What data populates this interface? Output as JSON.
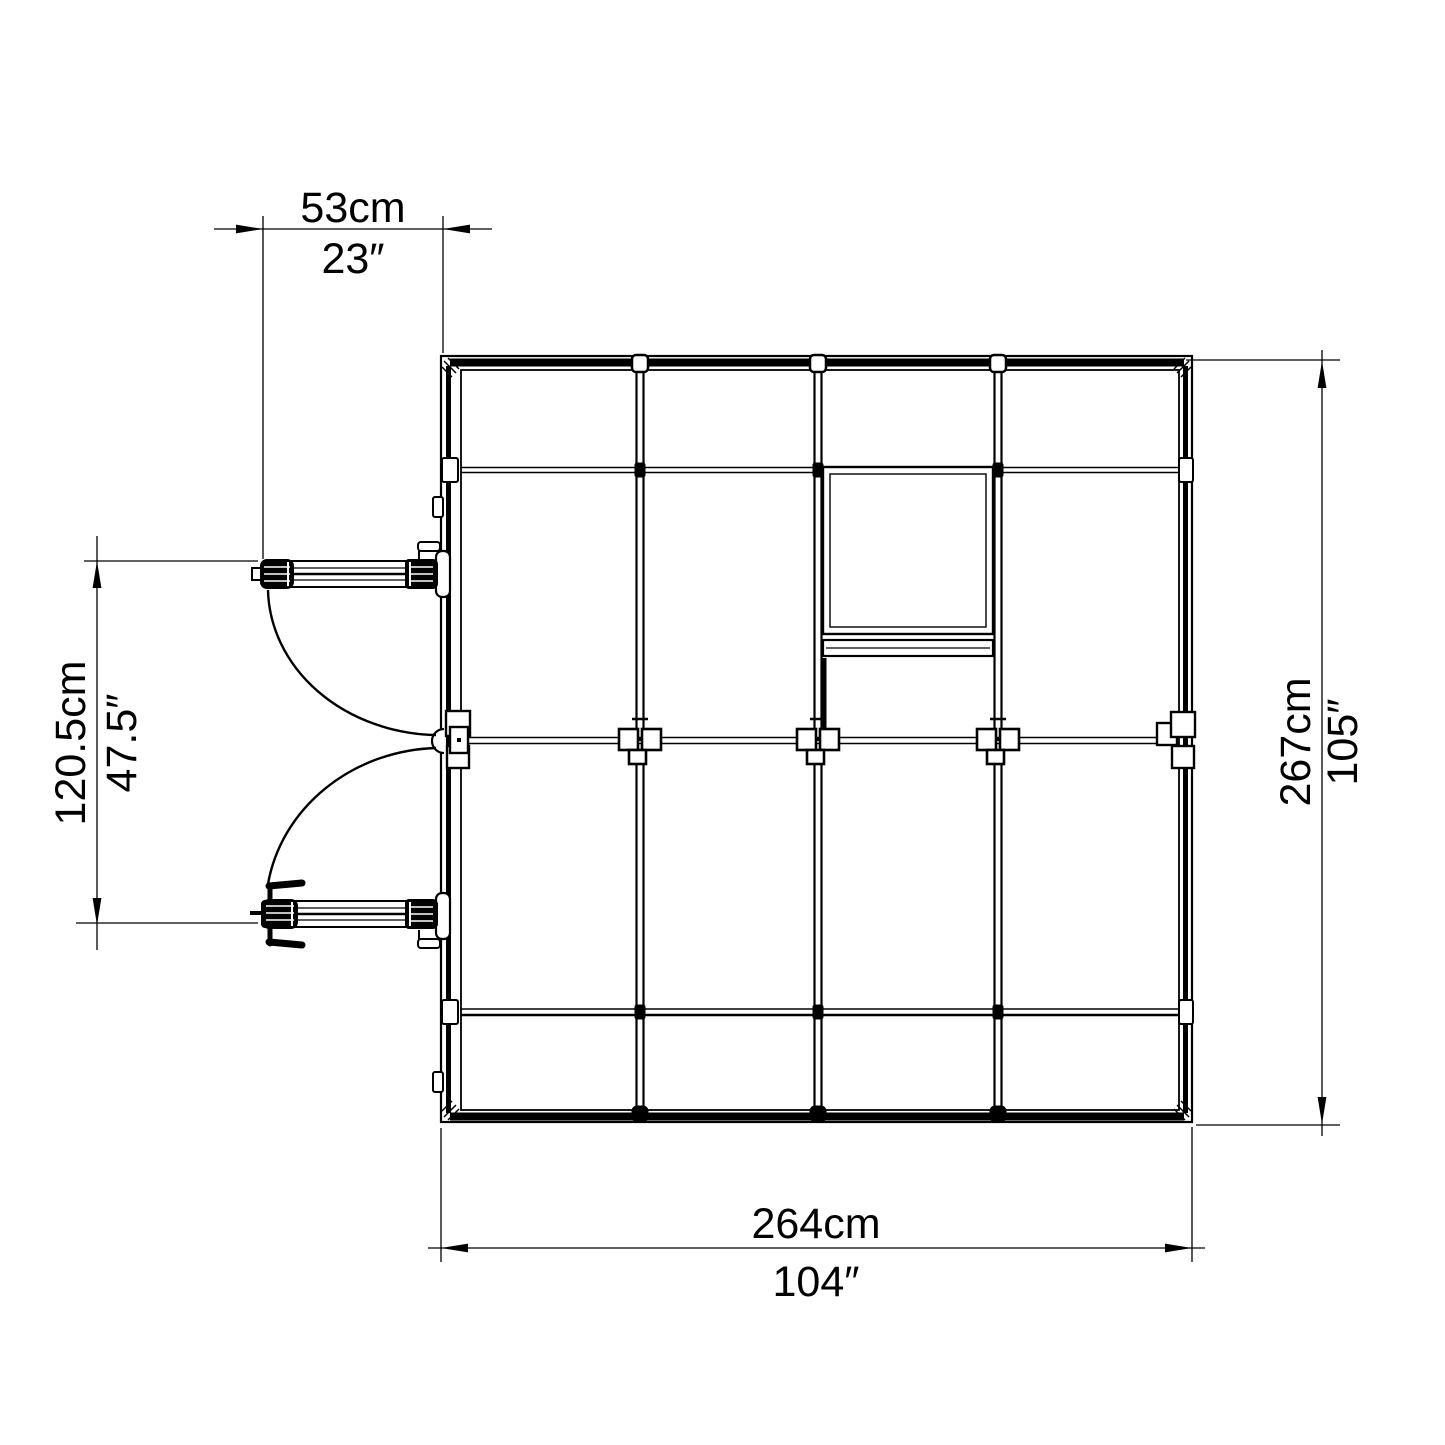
{
  "drawing": {
    "background": "#ffffff",
    "line_color": "#000000",
    "dimensions": {
      "top": {
        "metric": "53cm",
        "imperial": "23″"
      },
      "left": {
        "metric": "120.5cm",
        "imperial": "47.5″"
      },
      "right": {
        "metric": "267cm",
        "imperial": "105″"
      },
      "bottom": {
        "metric": "264cm",
        "imperial": "104″"
      }
    }
  }
}
